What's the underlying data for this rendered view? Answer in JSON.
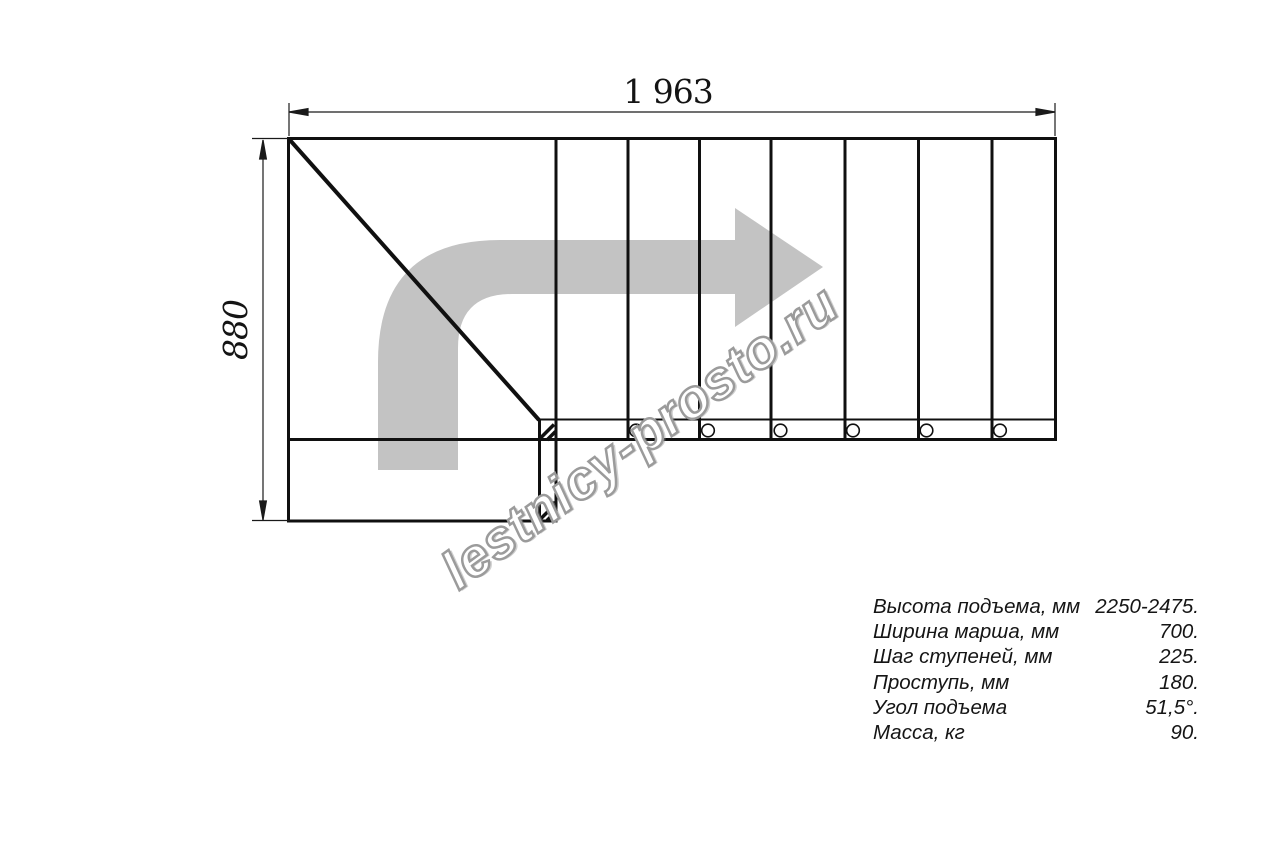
{
  "drawing": {
    "title": "staircase-plan-top-view",
    "width_dimension": "1 963",
    "height_dimension": "880",
    "watermark": "lestnicy-prosto.ru",
    "treads_shown": 7,
    "stringer_holes_shown": 6,
    "arrow_color": "#c3c3c3",
    "line_color": "#101010",
    "watermark_outline_color": "#9b9b9b"
  },
  "specifications": {
    "rows": [
      {
        "label": "Высота подъема, мм",
        "value": "2250-2475."
      },
      {
        "label": "Ширина марша, мм",
        "value": "700."
      },
      {
        "label": "Шаг ступеней, мм",
        "value": "225."
      },
      {
        "label": "Проступь, мм",
        "value": "180."
      },
      {
        "label": "Угол подъема",
        "value": "51,5°."
      },
      {
        "label": "Масса, кг",
        "value": "90."
      }
    ]
  }
}
